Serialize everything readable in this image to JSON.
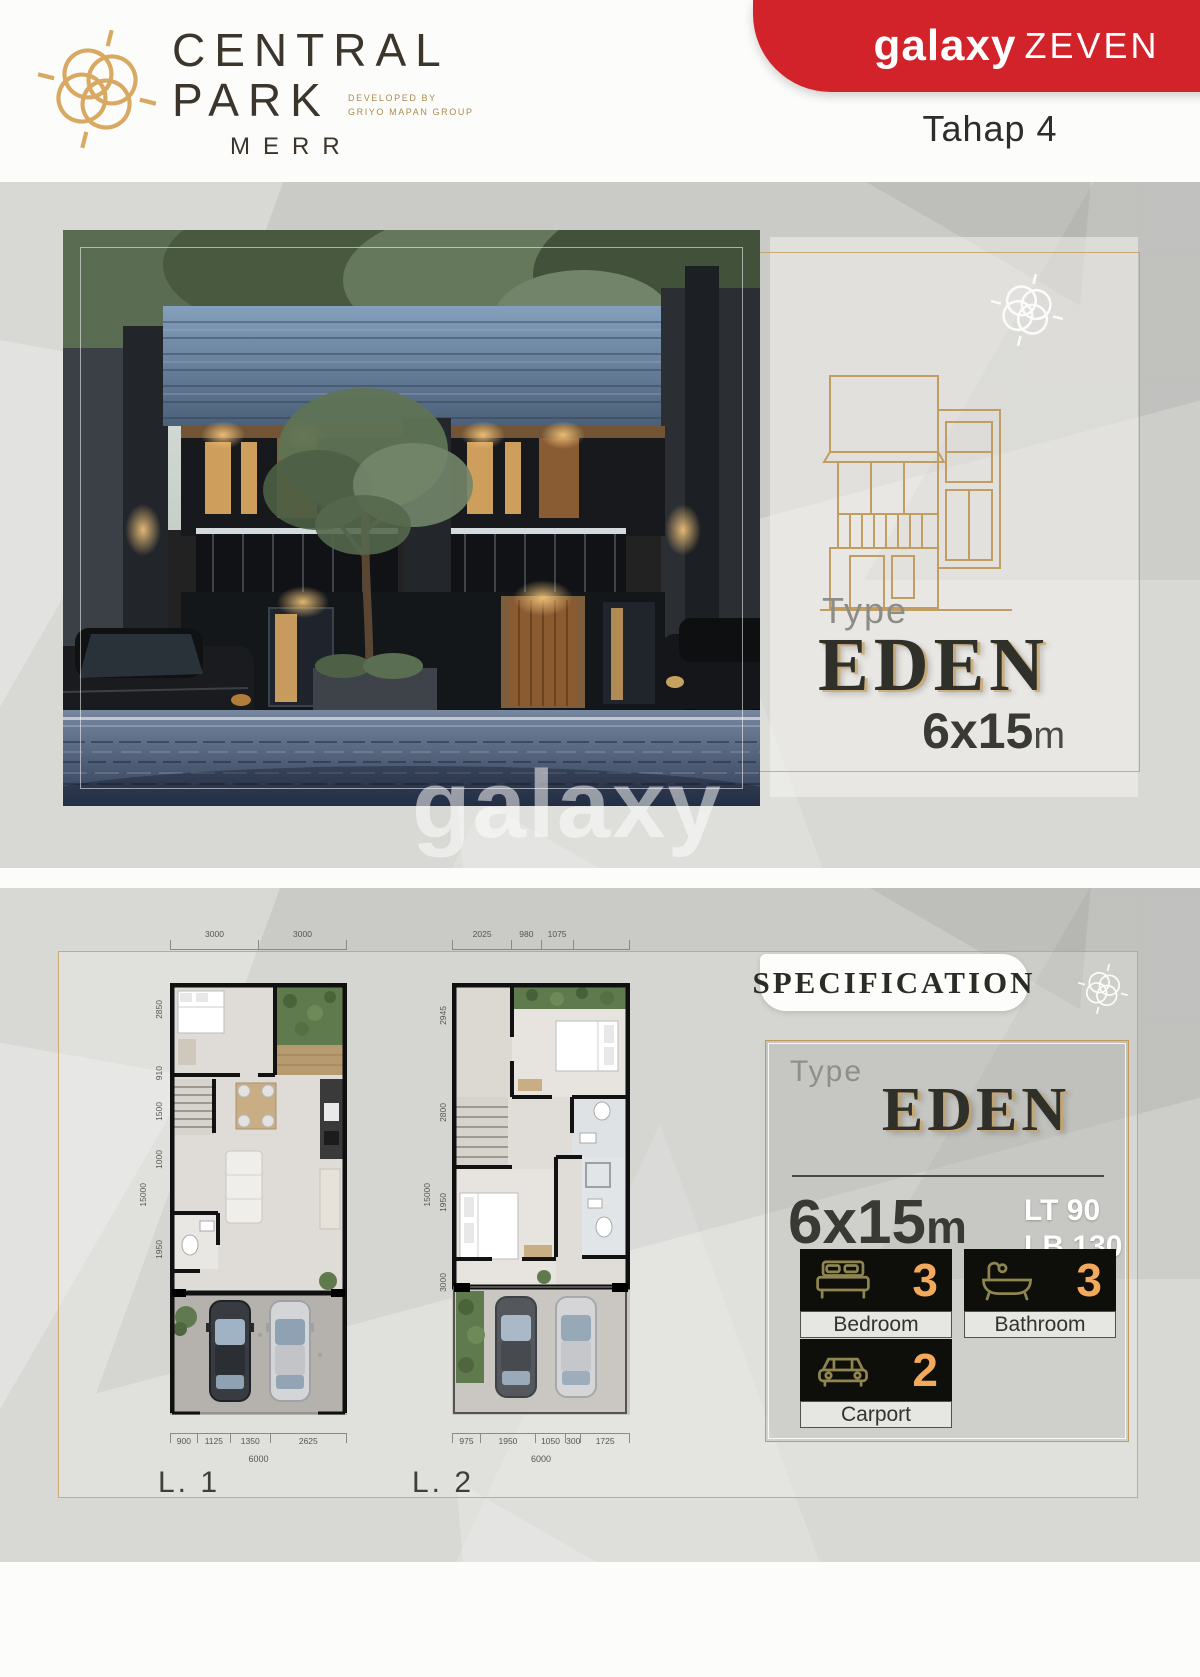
{
  "header": {
    "brand": {
      "line1": "CENTRAL",
      "line2": "PARK",
      "merr": "MERR",
      "developed_by": "DEVELOPED BY",
      "developer": "GRIYO MAPAN GROUP"
    },
    "banner": {
      "brand": "galaxy",
      "series": "ZEVEN"
    },
    "phase": "Tahap 4"
  },
  "colors": {
    "red": "#d2222a",
    "gold": "#c49a5a",
    "stat_number": "#f2a95c"
  },
  "hero": {
    "type_label": "Type",
    "type_name": "EDEN",
    "size": "6x15",
    "size_unit": "m",
    "watermark": "galaxy"
  },
  "specification": {
    "title": "SPECIFICATION",
    "type_label": "Type",
    "type_name": "EDEN",
    "size": "6x15",
    "size_unit": "m",
    "land_area": "LT 90",
    "building_area": "LB 130",
    "stats": [
      {
        "icon": "bed-icon",
        "value": "3",
        "label": "Bedroom"
      },
      {
        "icon": "bath-icon",
        "value": "3",
        "label": "Bathroom"
      },
      {
        "icon": "car-icon",
        "value": "2",
        "label": "Carport"
      }
    ]
  },
  "floorplans": {
    "l1": {
      "label": "L. 1",
      "top_dims": [
        "3000",
        "3000"
      ],
      "left_dims": [
        "2850",
        "910",
        "1500",
        "1000",
        "1950"
      ],
      "left_total": "15000",
      "bottom_dims": [
        "900",
        "1125",
        "1350",
        "2625"
      ],
      "bottom_total": "6000"
    },
    "l2": {
      "label": "L. 2",
      "top_dims": [
        "2025",
        "980",
        "1075"
      ],
      "left_dims": [
        "2945",
        "2800",
        "1950",
        "3000"
      ],
      "left_total": "15000",
      "bottom_dims": [
        "975",
        "1950",
        "1050",
        "300",
        "1725"
      ],
      "bottom_total": "6000"
    }
  }
}
